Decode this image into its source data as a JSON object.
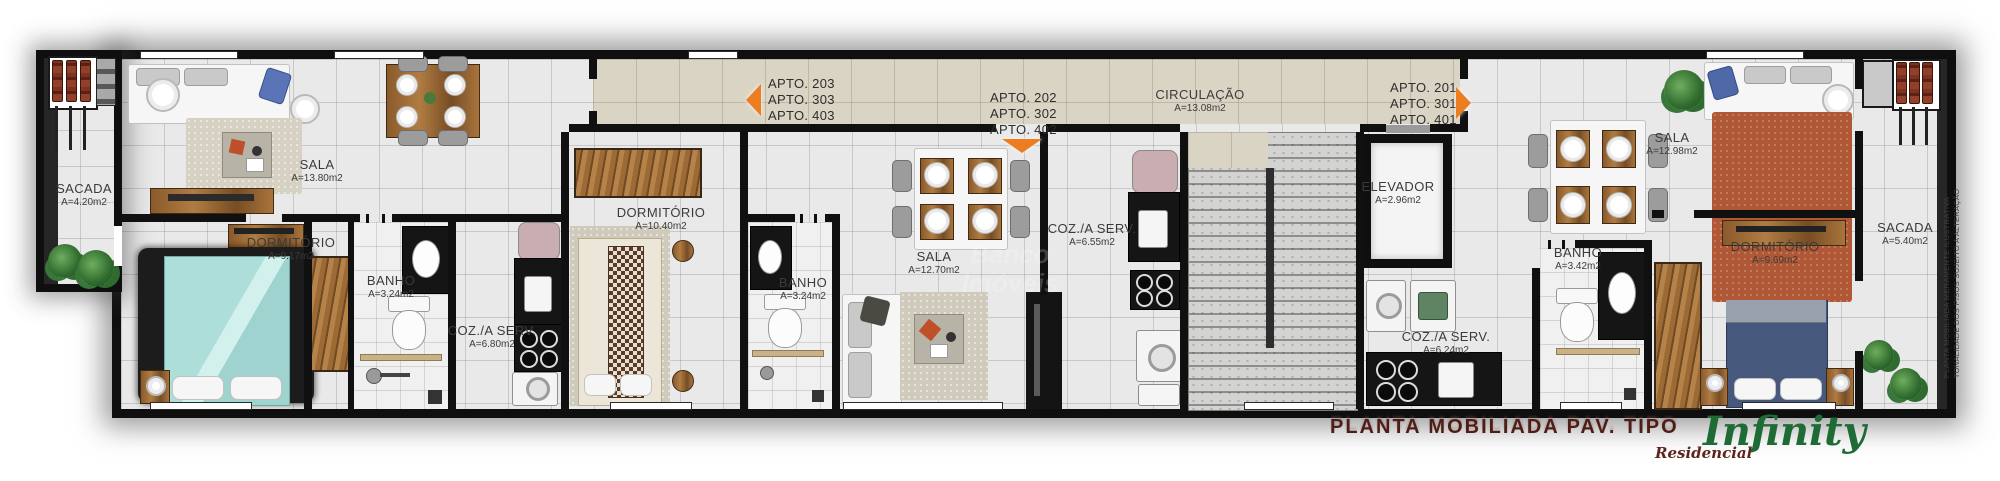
{
  "meta": {
    "caption": "PLANTA MOBILIADA PAV. TIPO",
    "caption_color": "#4f1d15",
    "arrow_color": "#ed7d21",
    "wall_color": "#101010",
    "floor_color": "#e9e9ea",
    "corridor_color": "#dad4c4"
  },
  "logo": {
    "brand": "Infinity",
    "subtitle": "Residencial",
    "brand_color": "#1f6b36",
    "subtitle_color": "#5d241d"
  },
  "disclaimer": {
    "line1": "PLANTA MOBILIADA MERAMENTE ILUSTRATIVA",
    "line2": "TONALIDADE DOS PISOS SUJEITO A ALTERAÇÃO"
  },
  "watermark": {
    "line1": "Banco",
    "line2": "Imóveis"
  },
  "signs": {
    "apto_left": {
      "lines": [
        "APTO. 203",
        "APTO. 303",
        "APTO. 403"
      ],
      "arrow": "left"
    },
    "apto_mid": {
      "lines": [
        "APTO. 202",
        "APTO. 302",
        "APTO. 402"
      ],
      "arrow": "down"
    },
    "apto_right": {
      "lines": [
        "APTO. 201",
        "APTO. 301",
        "APTO. 401"
      ],
      "arrow": "right"
    }
  },
  "rooms": {
    "sacada_left": {
      "label": "SACADA",
      "area": "A=4.20m2"
    },
    "sala_203": {
      "label": "SALA",
      "area": "A=13.80m2"
    },
    "dormitorio_203": {
      "label": "DORMITÓRIO",
      "area": "A=9.17m2"
    },
    "banho_203": {
      "label": "BANHO",
      "area": "A=3.24m2"
    },
    "coz_203": {
      "label": "COZ./A SERV.",
      "area": "A=6.80m2"
    },
    "dormitorio_202": {
      "label": "DORMITÓRIO",
      "area": "A=10.40m2"
    },
    "banho_202": {
      "label": "BANHO",
      "area": "A=3.24m2"
    },
    "sala_202": {
      "label": "SALA",
      "area": "A=12.70m2"
    },
    "coz_202": {
      "label": "COZ./A SERV.",
      "area": "A=6.55m2"
    },
    "circulacao": {
      "label": "CIRCULAÇÃO",
      "area": "A=13.08m2"
    },
    "elevador": {
      "label": "ELEVADOR",
      "area": "A=2.96m2"
    },
    "coz_201": {
      "label": "COZ./A SERV.",
      "area": "A=6.24m2"
    },
    "banho_201": {
      "label": "BANHO",
      "area": "A=3.42m2"
    },
    "sala_201": {
      "label": "SALA",
      "area": "A=12.98m2"
    },
    "dormitorio_201": {
      "label": "DORMITÓRIO",
      "area": "A=9.69m2"
    },
    "sacada_right": {
      "label": "SACADA",
      "area": "A=5.40m2"
    }
  }
}
